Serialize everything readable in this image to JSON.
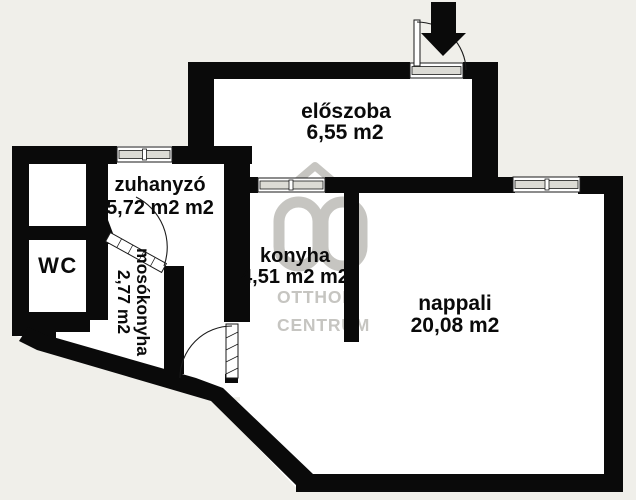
{
  "colors": {
    "background": "#f0efea",
    "wall": "#0a0a0a",
    "floor": "#ffffff",
    "watermark": "#c6c5c1",
    "label": "#0a0a0a"
  },
  "rooms": {
    "eloszoba": {
      "name": "előszoba",
      "area": "6,55 m2"
    },
    "zuhanyzo": {
      "name": "zuhanyzó",
      "area": "5,72 m2 m2"
    },
    "wc": {
      "name": "WC",
      "area": ""
    },
    "mosokonyha": {
      "name": "mosókonyha",
      "area": "2,77 m2"
    },
    "konyha": {
      "name": "konyha",
      "area": "4,51 m2 m2"
    },
    "nappali": {
      "name": "nappali",
      "area": "20,08 m2"
    }
  },
  "watermark": {
    "line1": "OTTHON",
    "line2": "CENTRUM"
  }
}
